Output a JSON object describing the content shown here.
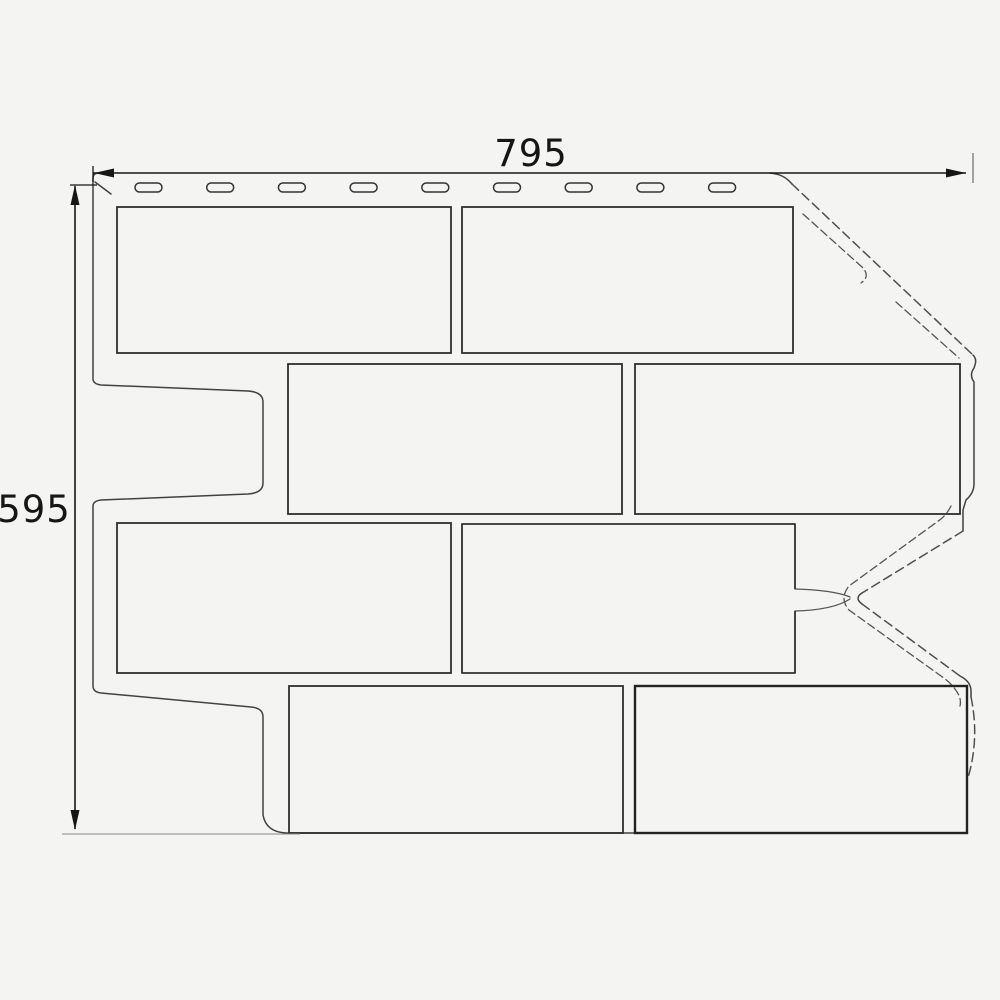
{
  "page": {
    "background": "#f4f4f2"
  },
  "drawing": {
    "subject": "Brick facade corner panel - dimensioned technical drawing",
    "dimensions": {
      "width": "795",
      "height": "595"
    },
    "nail_slots": {
      "count": 9,
      "start_x": 135,
      "step_x": 71.7,
      "y": 183,
      "width": 27,
      "height": 9,
      "radius": 4.5
    },
    "bricks": [
      {
        "x": 117,
        "y": 207,
        "w": 334,
        "h": 146
      },
      {
        "x": 462,
        "y": 207,
        "w": 331,
        "h": 146
      },
      {
        "x": 288,
        "y": 364,
        "w": 334,
        "h": 150
      },
      {
        "x": 635,
        "y": 364,
        "w": 325,
        "h": 150
      },
      {
        "x": 117,
        "y": 523,
        "w": 334,
        "h": 150
      },
      {
        "x": 289,
        "y": 686,
        "w": 334,
        "h": 147
      },
      {
        "x": 635,
        "y": 686,
        "w": 332,
        "h": 147,
        "thick": true
      }
    ],
    "colors": {
      "background": "#f4f4f2",
      "line": "#424242",
      "dashed_line": "#4f4f4f",
      "brick_line": "#2f2f2f",
      "dim_line": "#161616",
      "extension_line": "#6b6b6b"
    }
  }
}
